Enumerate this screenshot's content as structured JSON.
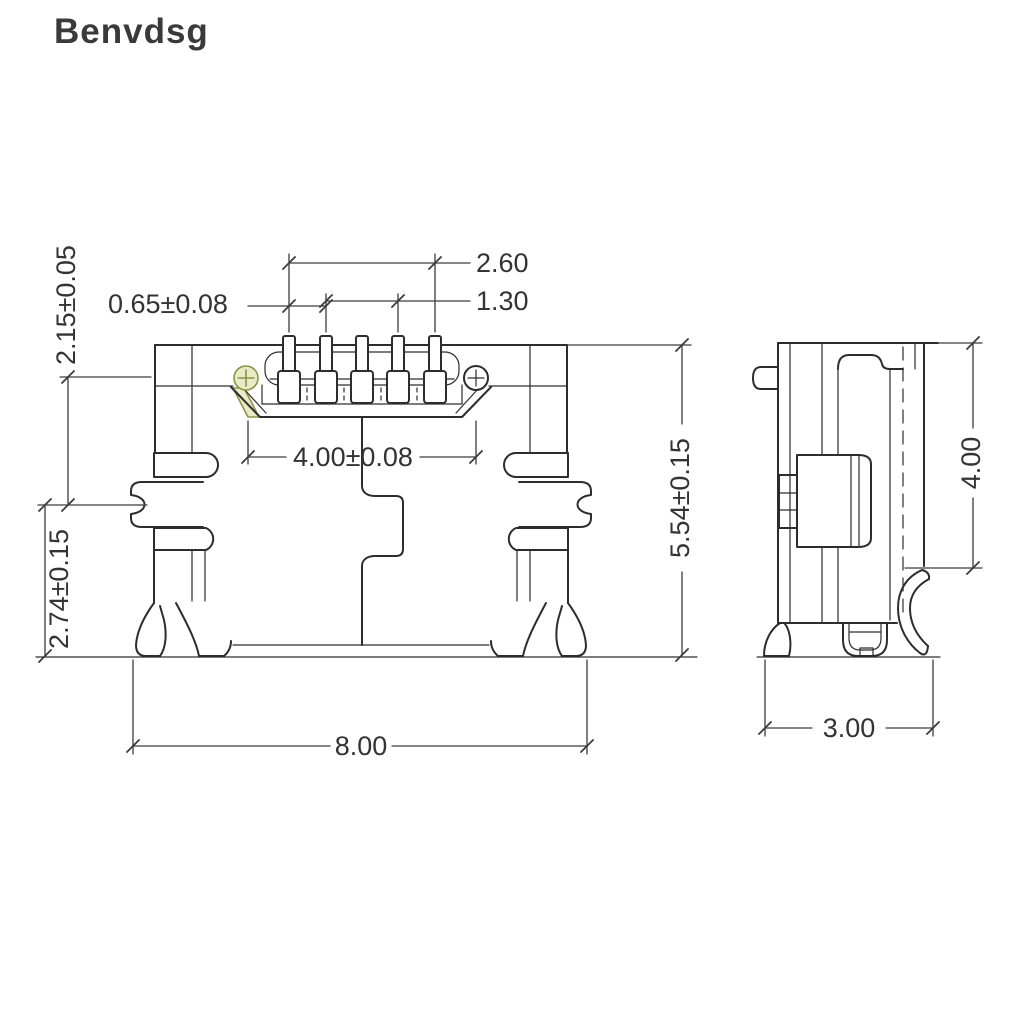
{
  "brand": "Benvdsg",
  "drawing": {
    "type": "technical-dimension-drawing",
    "subject": "micro-usb-connector",
    "colors": {
      "line": "#2d2d2d",
      "dimension": "#3c3c3c",
      "accent_stroke": "#8a9447",
      "accent_fill": "#e7ecc6",
      "background": "#ffffff"
    },
    "dims": {
      "pin_span": "2.60",
      "pin_pair": "1.30",
      "pin_pitch": "0.65±0.08",
      "upper_height": "2.15±0.05",
      "tongue_width": "4.00±0.08",
      "lower_height": "2.74±0.15",
      "overall_height": "5.54±0.15",
      "overall_width": "8.00",
      "side_height": "4.00",
      "side_depth": "3.00"
    }
  }
}
